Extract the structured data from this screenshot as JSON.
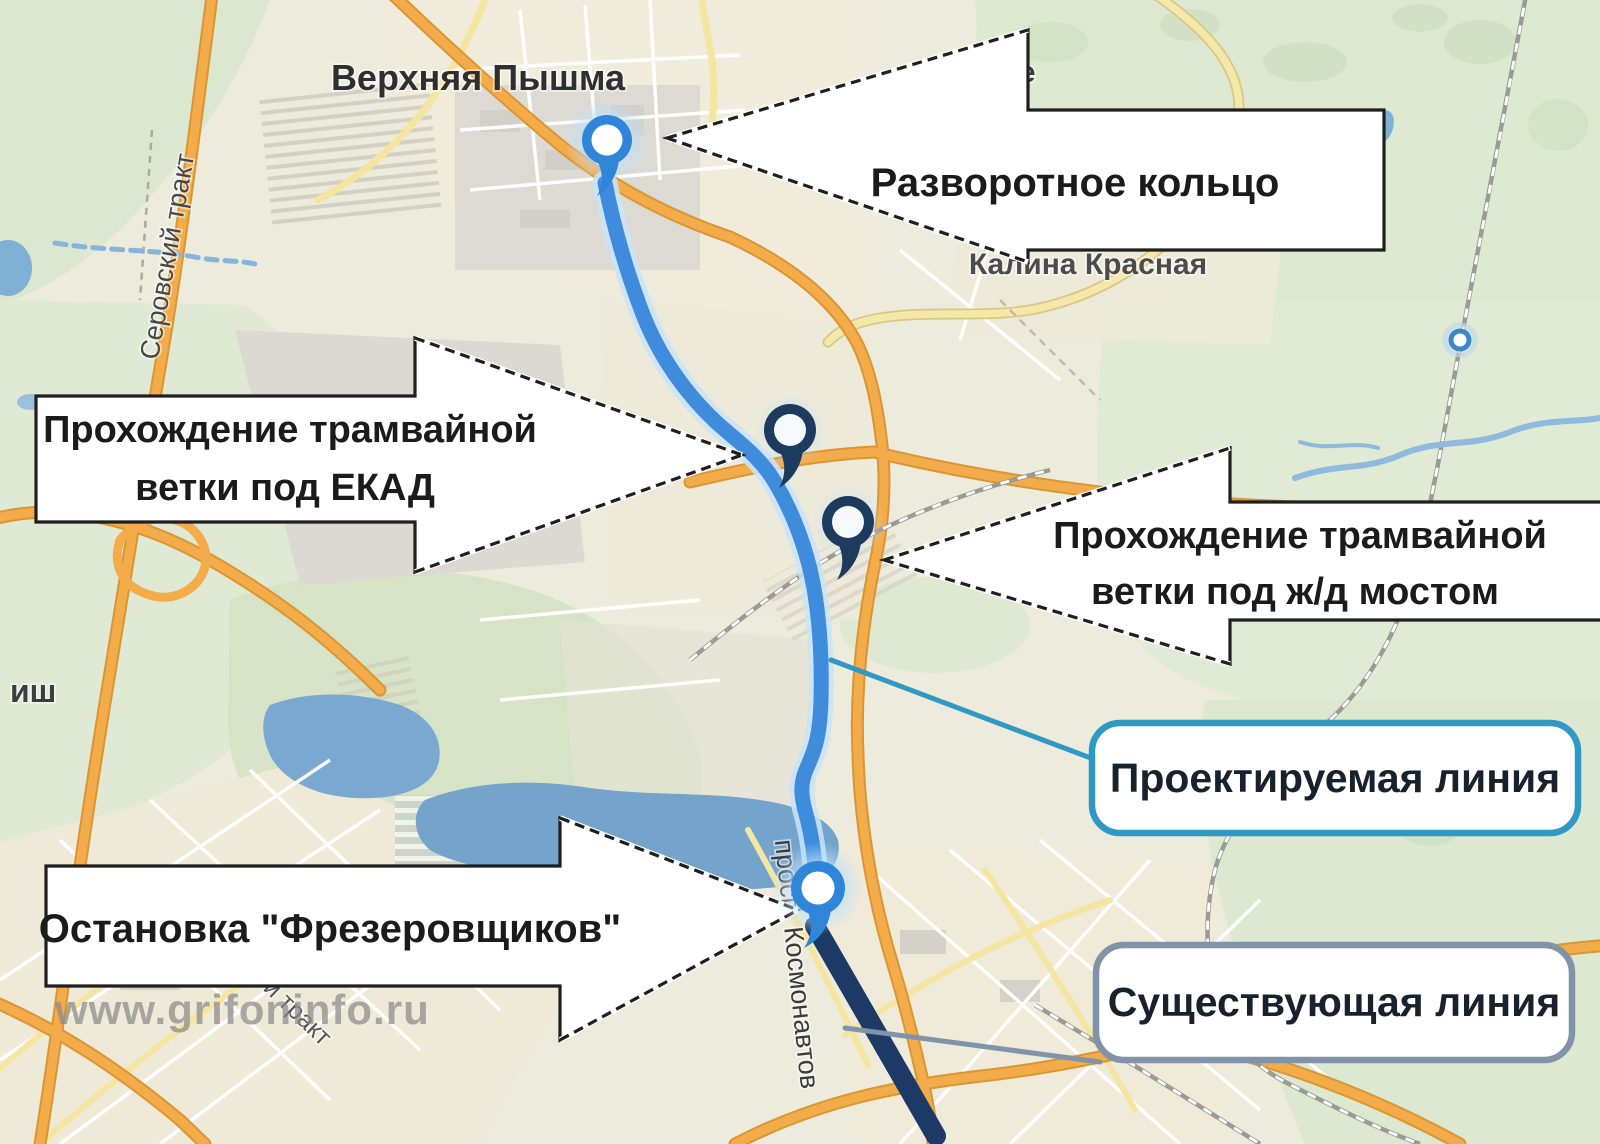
{
  "map_labels": {
    "city_top": "Верхняя Пышма",
    "settlement_partial_top": "ье",
    "settlement_right": "Калина Красная",
    "settlement_partial_left": "иш",
    "road_left_vertical": "Серовский тракт",
    "avenue_vertical": "просп. Космонавтов",
    "road_partial_bottom_left": "й тракт"
  },
  "watermark": "www.grifoninfo.ru",
  "callouts": {
    "turning_loop": {
      "label": "Разворотное кольцо"
    },
    "under_ekad": {
      "line1": "Прохождение трамвайной",
      "line2": "ветки под ЕКАД"
    },
    "under_rail_bridge": {
      "line1": "Прохождение трамвайной",
      "line2": "ветки под ж/д мостом"
    },
    "stop_frezerovshchikov": {
      "label": "Остановка \"Фрезеровщиков\""
    }
  },
  "legend": {
    "projected": {
      "label": "Проектируемая линия",
      "border_color": "#2f99c4"
    },
    "existing": {
      "label": "Существующая линия",
      "border_color": "#8093a8"
    }
  },
  "route": {
    "projected_color": "#3f8cdd",
    "projected_halo": "#c9e4f9",
    "existing_color": "#1d3a66"
  },
  "markers": {
    "light_pin_color": "#2f86d8",
    "dark_pin_color": "#1d3a5f",
    "small_circle_color": "#3e87c9"
  }
}
